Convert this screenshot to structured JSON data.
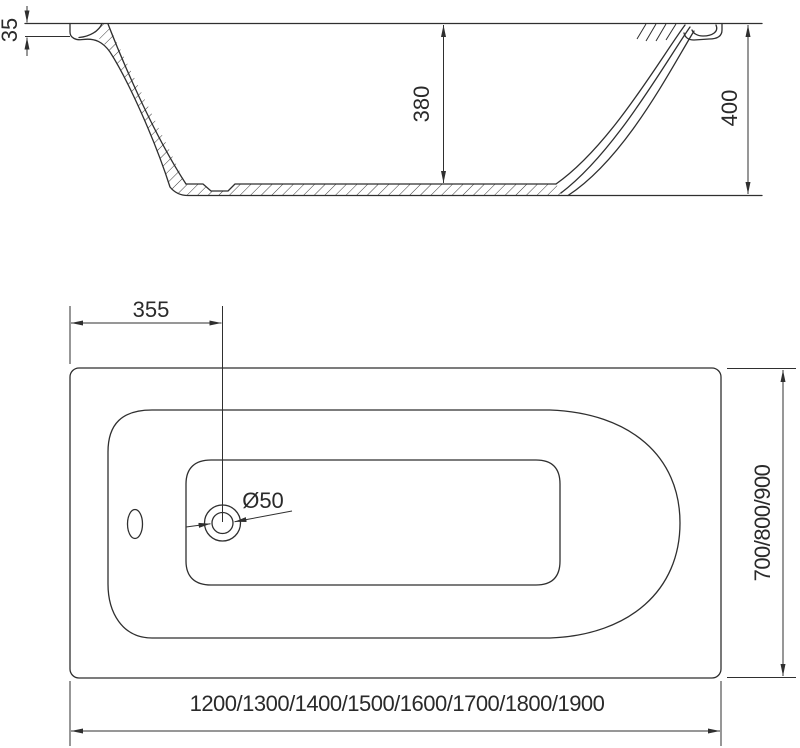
{
  "drawing": {
    "type": "bathtub technical drawing",
    "background_color": "#ffffff",
    "line_color": "#2f2f2f",
    "side_view": {
      "name": "side section view",
      "rim_thickness_label": "35",
      "inner_depth_label": "380",
      "overall_height_label": "400"
    },
    "top_view": {
      "name": "top plan view",
      "drain_offset_label": "355",
      "drain_diameter_label": "Ø50",
      "width_options_label": "700/800/900",
      "length_options_label": "1200/1300/1400/1500/1600/1700/1800/1900"
    }
  }
}
